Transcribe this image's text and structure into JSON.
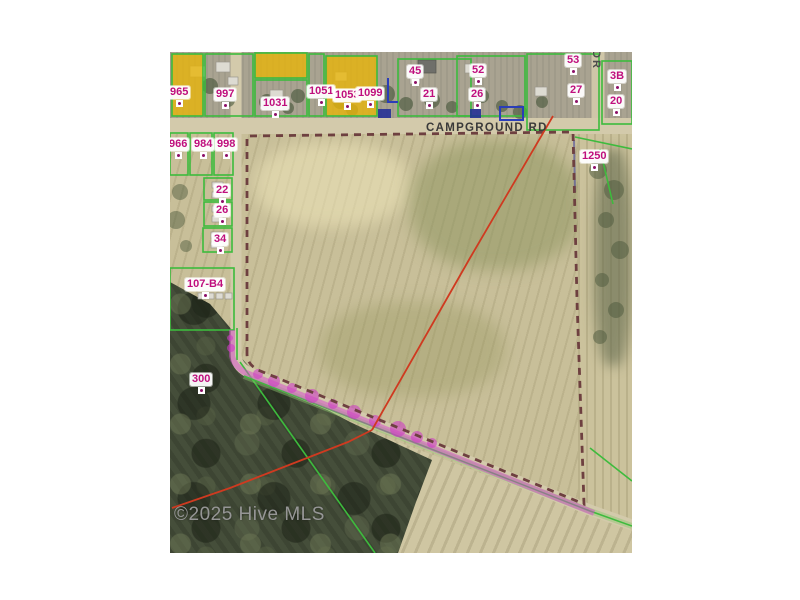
{
  "attribution": {
    "text": "©2025 Hive MLS"
  },
  "roads": {
    "campground_rd": {
      "label": "CAMPGROUND RD"
    },
    "side_road": {
      "label": "DR"
    }
  },
  "parcel_labels": [
    {
      "text": "965"
    },
    {
      "text": "997"
    },
    {
      "text": "1031"
    },
    {
      "text": "1051"
    },
    {
      "text": "1053"
    },
    {
      "text": "1099"
    },
    {
      "text": "45"
    },
    {
      "text": "21"
    },
    {
      "text": "52"
    },
    {
      "text": "26"
    },
    {
      "text": "53"
    },
    {
      "text": "27"
    },
    {
      "text": "3B"
    },
    {
      "text": "20"
    },
    {
      "text": "1250"
    },
    {
      "text": "966"
    },
    {
      "text": "984"
    },
    {
      "text": "998"
    },
    {
      "text": "22"
    },
    {
      "text": "26"
    },
    {
      "text": "34"
    },
    {
      "text": "107-B4"
    },
    {
      "text": "300"
    }
  ],
  "colors": {
    "label_text": "#bf0f7d",
    "parcel_outline_green": "#3dbb3d",
    "highlighted_parcel_yellow": "#e7b40a",
    "subject_boundary_dash": "#6e4040",
    "road_frontage_magenta": "#d648ce",
    "survey_line_red": "#cf3a20",
    "secondary_outline_blue": "#2a3db8"
  }
}
